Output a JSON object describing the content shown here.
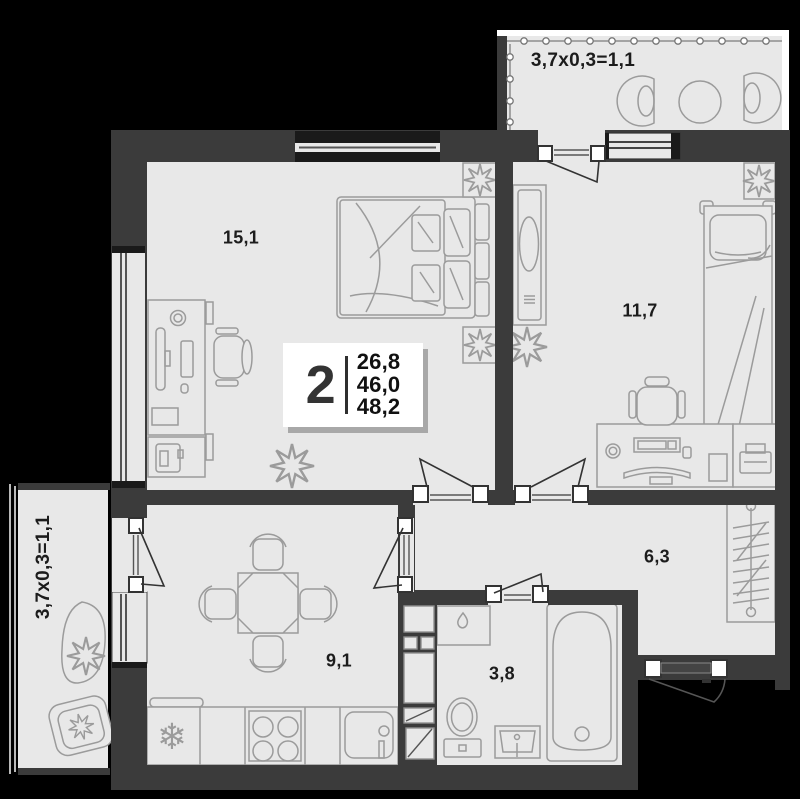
{
  "plan": {
    "info": {
      "rooms_count": "2",
      "areas": [
        "26,8",
        "46,0",
        "48,2"
      ]
    },
    "rooms": [
      {
        "id": "living-room",
        "area": "15,1"
      },
      {
        "id": "bedroom",
        "area": "11,7"
      },
      {
        "id": "hallway",
        "area": "6,3"
      },
      {
        "id": "kitchen",
        "area": "9,1"
      },
      {
        "id": "bathroom",
        "area": "3,8"
      }
    ],
    "balconies": [
      {
        "id": "balcony-top",
        "label": "3,7x0,3=1,1"
      },
      {
        "id": "balcony-left",
        "label": "3,7x0,3=1,1"
      }
    ],
    "colors": {
      "background": "#000000",
      "wall": "#3b3b3b",
      "floor": "#e8e8e8",
      "furniture_line": "#9b9b9b",
      "text": "#1c1c1c",
      "info_bg": "#ffffff"
    }
  }
}
